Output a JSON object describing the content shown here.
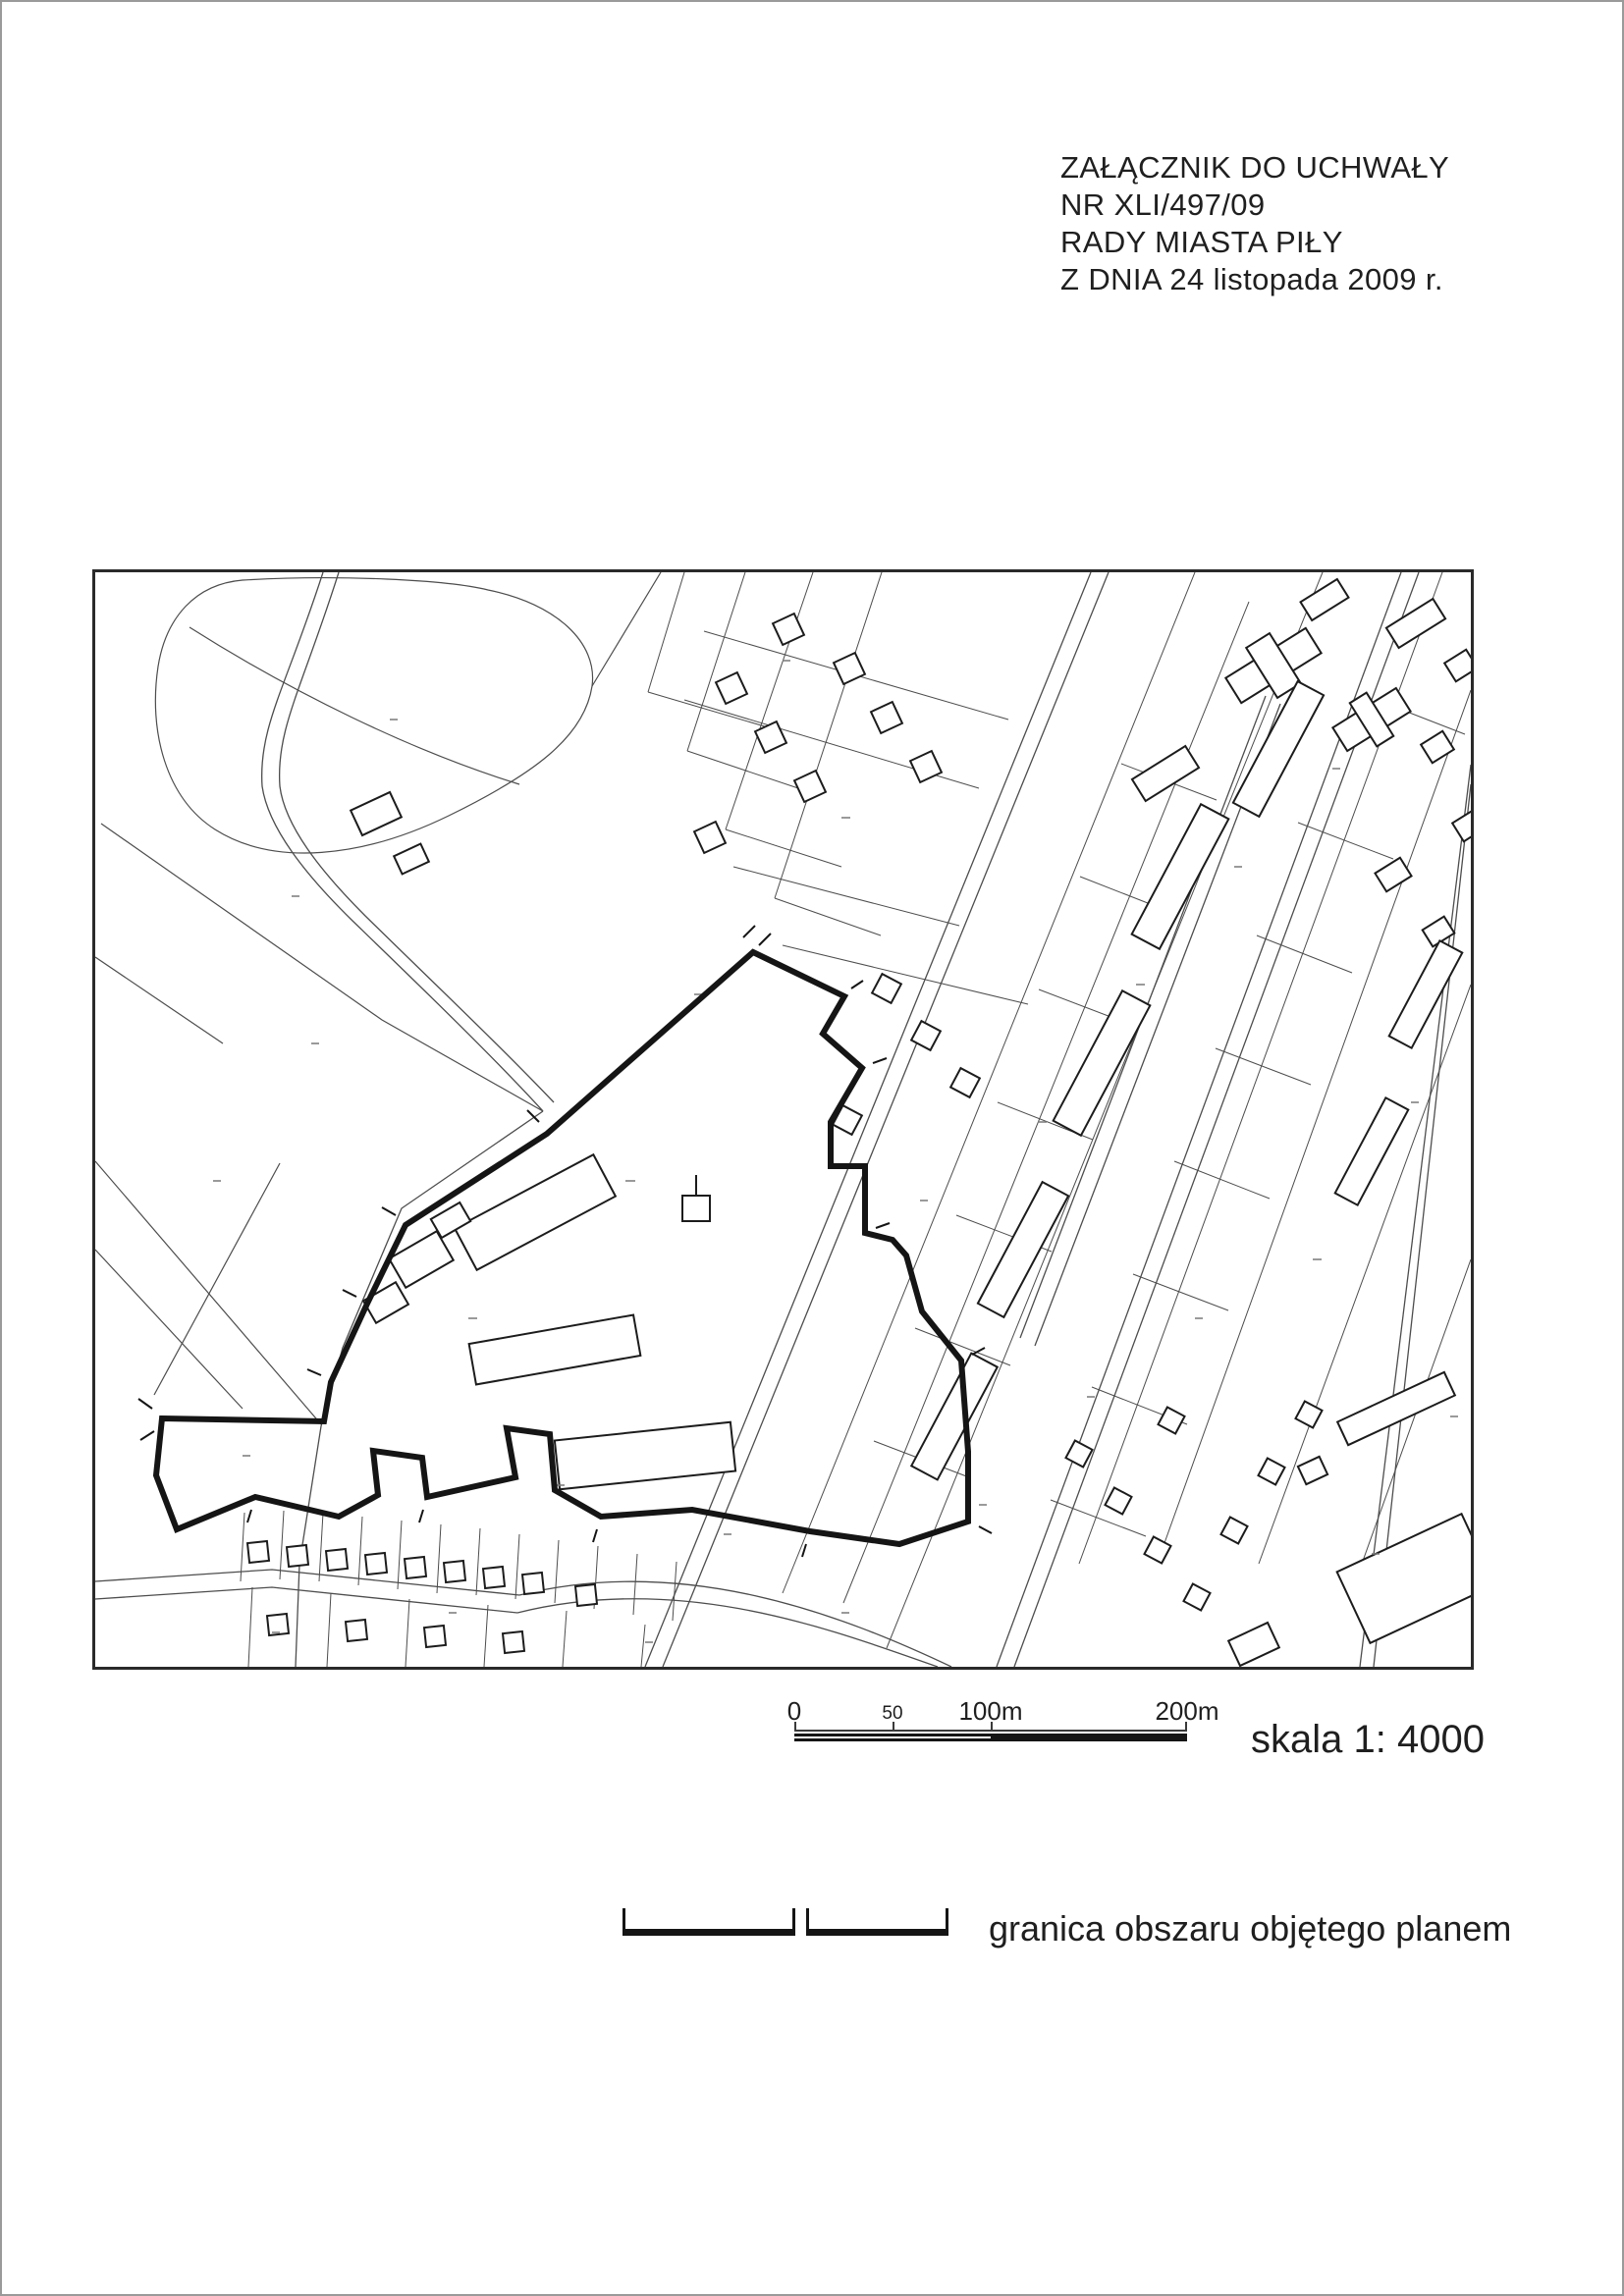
{
  "document": {
    "title_lines": [
      "ZAŁĄCZNIK DO UCHWAŁY",
      "NR XLI/497/09",
      "RADY MIASTA PIŁY",
      "Z DNIA 24 listopada 2009 r."
    ]
  },
  "scale_bar": {
    "ticks": [
      "0",
      "50",
      "100m",
      "200m"
    ],
    "label": "skala 1: 4000"
  },
  "legend": {
    "items": [
      {
        "symbol": "plan-boundary-line",
        "label": "granica obszaru objętego planem"
      }
    ]
  },
  "colors": {
    "text": "#1f1f1f",
    "boundary": "#151515",
    "frame": "#2a2a2a",
    "parcel_line": "#4d4d4d",
    "building": "#1c1c1c",
    "page_border": "#9a9a9a",
    "label_speck": "#787878"
  }
}
